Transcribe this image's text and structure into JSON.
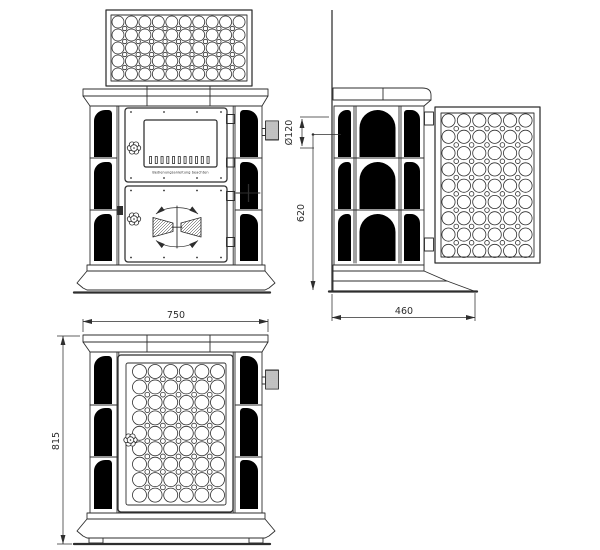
{
  "labels": {
    "width": "750",
    "height": "815",
    "depth": "460",
    "flue_center_height": "620",
    "flue_diameter": "Ø120",
    "door_notice": "Bedienungsanleitung beachten"
  },
  "colors": {
    "line": "#2e2e2e",
    "background": "#ffffff"
  }
}
